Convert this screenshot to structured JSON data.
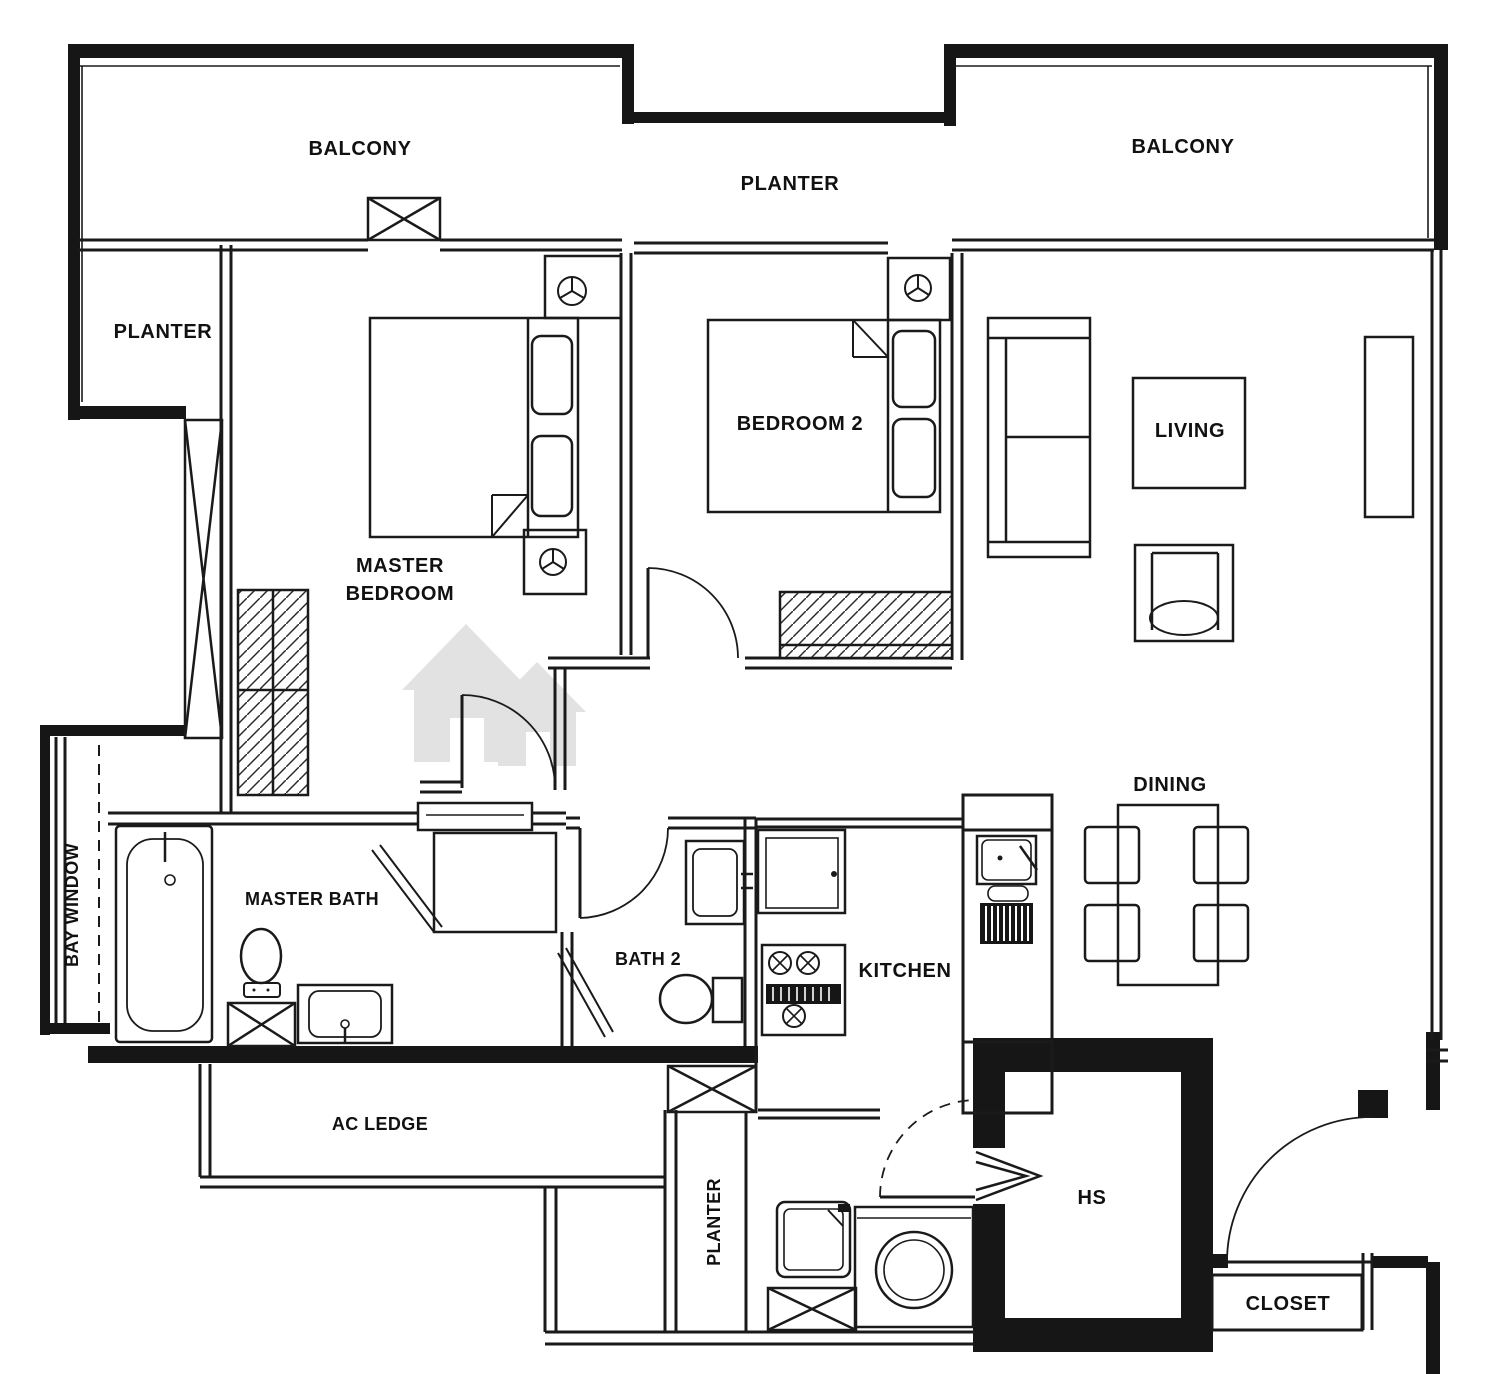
{
  "document": {
    "type": "apartment-floor-plan"
  },
  "colors": {
    "background": "#ffffff",
    "line": "#1a1a1a",
    "wall": "#161616",
    "text": "#111111",
    "watermark": "#c6c6c6"
  },
  "labels": {
    "balcony_left": "BALCONY",
    "planter_top": "PLANTER",
    "balcony_right": "BALCONY",
    "planter_left": "PLANTER",
    "master_bedroom_line1": "MASTER",
    "master_bedroom_line2": "BEDROOM",
    "bedroom2": "BEDROOM 2",
    "living": "LIVING",
    "dining": "DINING",
    "bay_window": "BAY WINDOW",
    "master_bath": "MASTER BATH",
    "bath2": "BATH 2",
    "kitchen": "KITCHEN",
    "ac_ledge": "AC LEDGE",
    "planter_bottom": "PLANTER",
    "hs": "HS",
    "closet": "CLOSET"
  },
  "icons": {
    "fan_coil_icon": "circle-with-three-spokes",
    "shaft_icon": "crossed-box",
    "door_icon": "quarter-arc-swing",
    "watermark_icon": "twin-houses"
  }
}
